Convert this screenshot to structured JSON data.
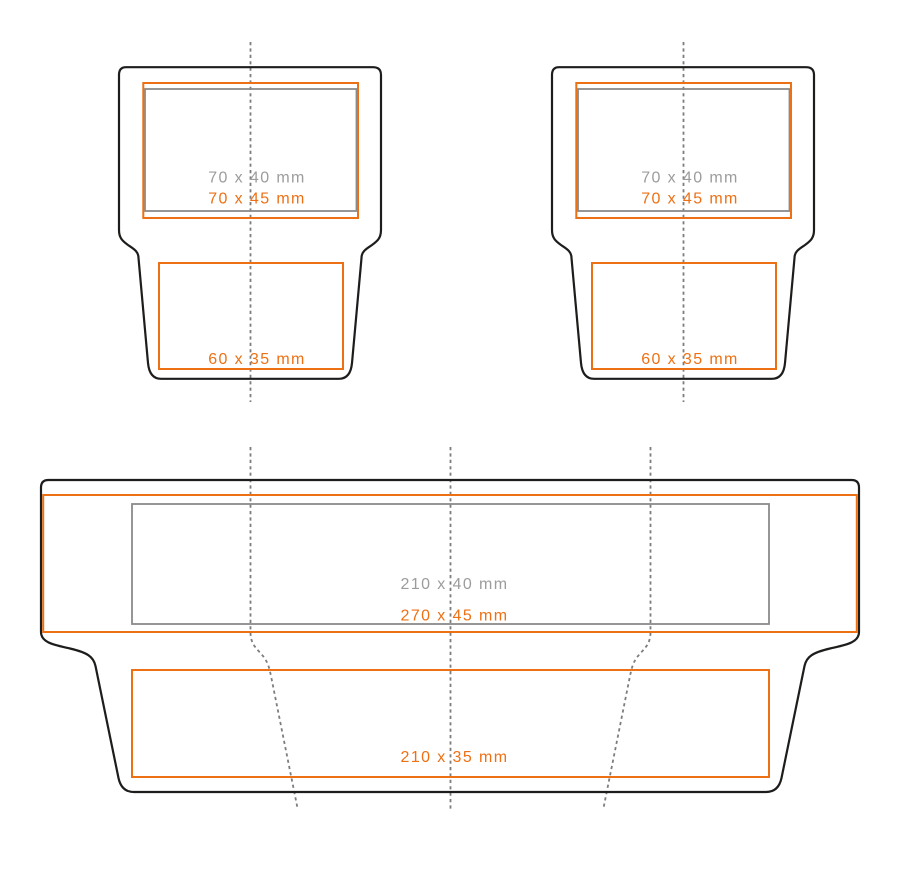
{
  "diagram": {
    "unit": "mm",
    "small_blank": {
      "standard_area_label": "70 x 40 mm",
      "max_area_label": "70 x 45 mm",
      "flap_area_label": "60 x 35 mm"
    },
    "large_blank": {
      "standard_area_label": "210 x 40 mm",
      "max_area_label": "270 x 45 mm",
      "flap_area_label": "210 x 35 mm"
    }
  },
  "colors": {
    "background": "#ffffff",
    "outline": "#1d1d1b",
    "orange": "#ed7014",
    "gray_box": "#8a8a8a",
    "gray_text": "#9c9c9c",
    "fold_line": "#7d7d7d"
  }
}
